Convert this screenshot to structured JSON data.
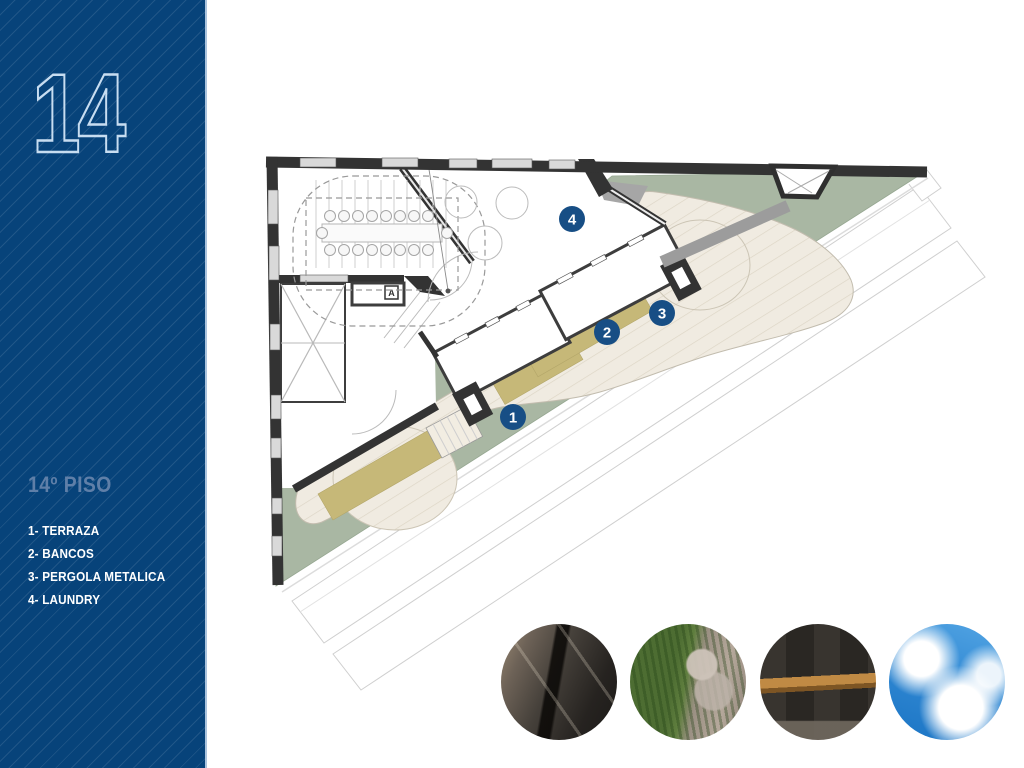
{
  "sidebar": {
    "big_number": "14",
    "floor_label": "14º PISO",
    "legend": [
      "1- TERRAZA",
      "2- BANCOS",
      "3- PERGOLA METALICA",
      "4- LAUNDRY"
    ],
    "colors": {
      "background": "#07437A",
      "stripe": "rgba(255,255,255,0.10)",
      "big_number_outline": "#C7DDF1",
      "floor_label": "#5F7FA8",
      "legend_text": "#FFFFFF"
    }
  },
  "plan": {
    "door_label": "A",
    "markers": [
      {
        "n": "1",
        "x": 513,
        "y": 417,
        "label": "TERRAZA"
      },
      {
        "n": "2",
        "x": 607,
        "y": 332,
        "label": "BANCOS"
      },
      {
        "n": "3",
        "x": 662,
        "y": 313,
        "label": "PERGOLA METALICA"
      },
      {
        "n": "4",
        "x": 572,
        "y": 219,
        "label": "LAUNDRY"
      }
    ],
    "colors": {
      "terrace_green": "#A9B7A3",
      "deck": "#F0EBE1",
      "deck_line": "#DCD5C5",
      "planter": "#C6B878",
      "wall": "#333333",
      "window": "#D9D9D9",
      "marker": "#174E85",
      "site_line": "#CCCCCC"
    }
  },
  "photos": [
    {
      "name": "pergola-metal-structure"
    },
    {
      "name": "grass-and-gravel-terrace"
    },
    {
      "name": "wood-bench-on-dark-wall"
    },
    {
      "name": "blue-sky-with-clouds"
    }
  ]
}
